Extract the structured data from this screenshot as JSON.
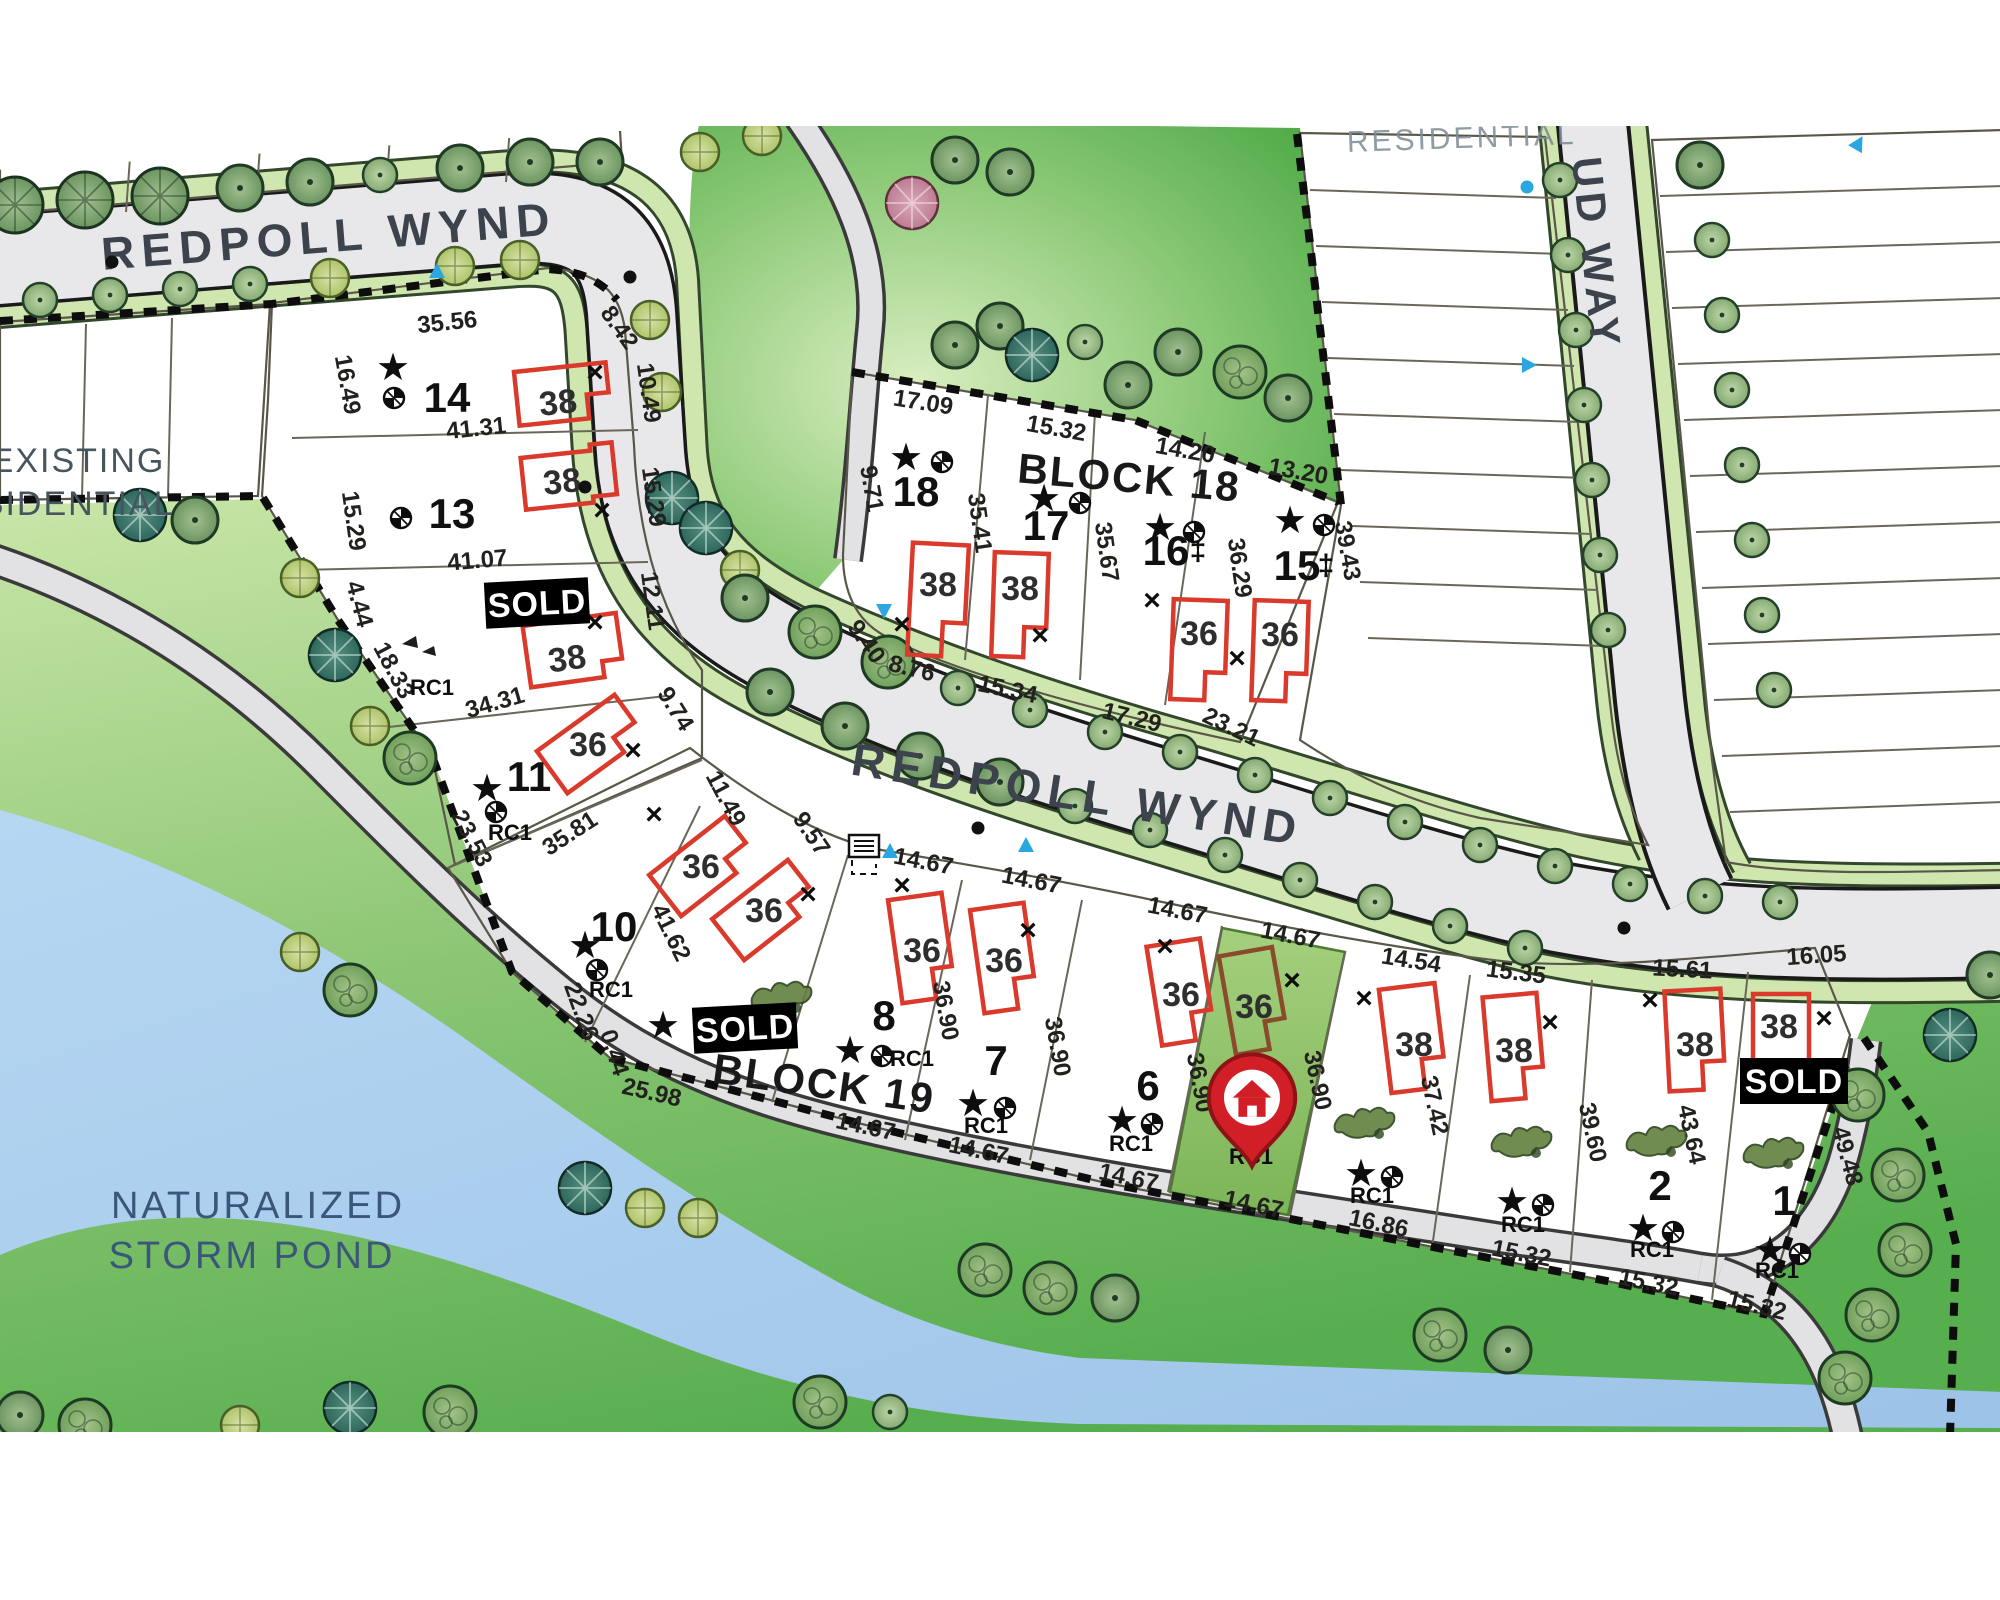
{
  "streets": {
    "redpoll_top": "REDPOLL WYND",
    "redpoll_mid": "REDPOLL WYND",
    "ud_way": "UD WAY"
  },
  "areas": {
    "existing_line1": "EXISTING",
    "existing_line2": "RESIDENTIAL",
    "residential_top": "RESIDENTIAL",
    "pond_line1": "NATURALIZED",
    "pond_line2": "STORM POND"
  },
  "blocks": {
    "b18": "BLOCK 18",
    "b19": "BLOCK 19"
  },
  "badges": {
    "sold": "SOLD"
  },
  "zoning": {
    "rc1": "RC1"
  },
  "icons": {
    "star": "★",
    "x": "×",
    "double_dagger": "‡"
  },
  "colors": {
    "lot_fill": "#f8eebc",
    "highlight_lot": "#8fbe62",
    "house_outline": "#d93a2b",
    "sold_bg": "#000000",
    "pond": "#a9cdec",
    "park": "#5fb353",
    "street": "#e8e8ea",
    "pin": "#d21e26"
  },
  "lots": {
    "14": {
      "number": "14",
      "model": "38",
      "dim_top": "35.56",
      "dim_left": "16.49",
      "dim_bottom": "41.31",
      "dim_right_a": "8.42",
      "dim_right_b": "10.49"
    },
    "13": {
      "number": "13",
      "model": "38",
      "dim_left": "15.29",
      "dim_right": "15.29",
      "dim_bottom": "41.07"
    },
    "12": {
      "status": "SOLD",
      "model": "38",
      "dim_left": "4.44",
      "dim_sw": "18.33",
      "dim_right": "12.11",
      "dim_bottom": "34.31"
    },
    "11": {
      "number": "11",
      "model": "36",
      "dim_sw": "23.53",
      "dim_bottom": "35.81",
      "dim_right": "9.74"
    },
    "10": {
      "number": "10",
      "dim_sw": "22.26",
      "dim_sw_b": "0.44",
      "dim_ne": "41.62",
      "dim_curve_a": "11.49",
      "dim_curve_b": "9.57"
    },
    "18": {
      "number": "18",
      "model": "38",
      "dim_top": "17.09",
      "dim_left": "9.71",
      "dim_right": "35.41",
      "dim_bottom": "8.76",
      "dim_curve": "9.40"
    },
    "17": {
      "number": "17",
      "model": "38",
      "dim_top": "15.32",
      "dim_right": "35.67",
      "dim_bottom": "15.34"
    },
    "16": {
      "number": "16",
      "model": "36",
      "dim_top": "14.20",
      "dim_right": "36.29",
      "dim_bottom": "17.29"
    },
    "15": {
      "number": "15",
      "model": "36",
      "dim_top": "13.20",
      "dim_right": "39.43",
      "dim_bottom": "23.21"
    },
    "9": {
      "status": "SOLD",
      "model_a": "36",
      "model_b": "36",
      "dim_bottom": "25.98"
    },
    "8": {
      "number": "8",
      "model": "36",
      "dim_top": "14.67",
      "dim_right": "36.90",
      "dim_bottom": "14.67"
    },
    "7": {
      "number": "7",
      "model": "36",
      "dim_top": "14.67",
      "dim_right": "36.90",
      "dim_bottom": "14.67"
    },
    "6": {
      "number": "6",
      "model": "36",
      "dim_top": "14.67",
      "dim_right": "36.90",
      "dim_bottom": "14.67"
    },
    "5": {
      "model": "36",
      "dim_top": "14.67",
      "dim_right": "36.90",
      "dim_bottom": "14.67"
    },
    "4": {
      "model": "38",
      "dim_top": "14.54",
      "dim_right": "37.42",
      "dim_bottom": "16.86"
    },
    "3": {
      "model": "38",
      "dim_top": "15.35",
      "dim_right": "39.60",
      "dim_bottom": "15.32"
    },
    "2": {
      "number": "2",
      "model": "38",
      "dim_top": "15.61",
      "dim_right": "43.64",
      "dim_bottom": "15.32"
    },
    "1": {
      "number": "1",
      "status": "SOLD",
      "model": "38",
      "dim_top": "16.05",
      "dim_right": "49.48",
      "dim_bottom": "15.32"
    }
  }
}
